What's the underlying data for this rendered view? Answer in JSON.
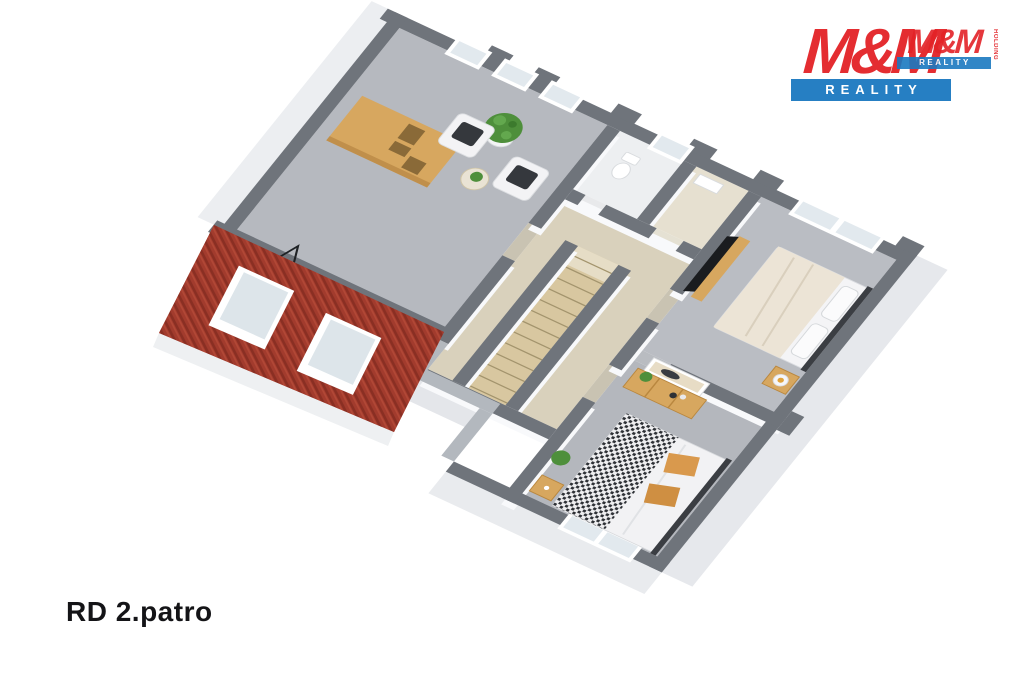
{
  "caption": {
    "text": "RD 2.patro"
  },
  "logo": {
    "main": {
      "wordmark": "M&M",
      "banner": "REALITY"
    },
    "watermark": {
      "wordmark": "M&M",
      "banner": "REALITY",
      "side_text": "HOLDING"
    }
  },
  "palette": {
    "brand_red": "#e32227",
    "brand_blue": "#1b79c0",
    "roof_red": "#a23b2d",
    "wall_top_gray": "#6f747b",
    "floor_gray": "#b6b9bf",
    "furniture_tan": "#d7a75f"
  },
  "floorplan": {
    "view": "3d-axonometric-floor-plan",
    "features": [
      "sloped-roof",
      "roof-window",
      "roof-window",
      "wardrobe",
      "armchair",
      "armchair",
      "side-table",
      "potted-plant",
      "desk",
      "floor-lamp",
      "staircase",
      "toilet",
      "washbasin",
      "double-bed",
      "double-bed",
      "tv",
      "tv-stand",
      "nightstand",
      "nightstand",
      "dresser",
      "wall-picture",
      "window",
      "window",
      "window",
      "window",
      "window",
      "window"
    ]
  }
}
